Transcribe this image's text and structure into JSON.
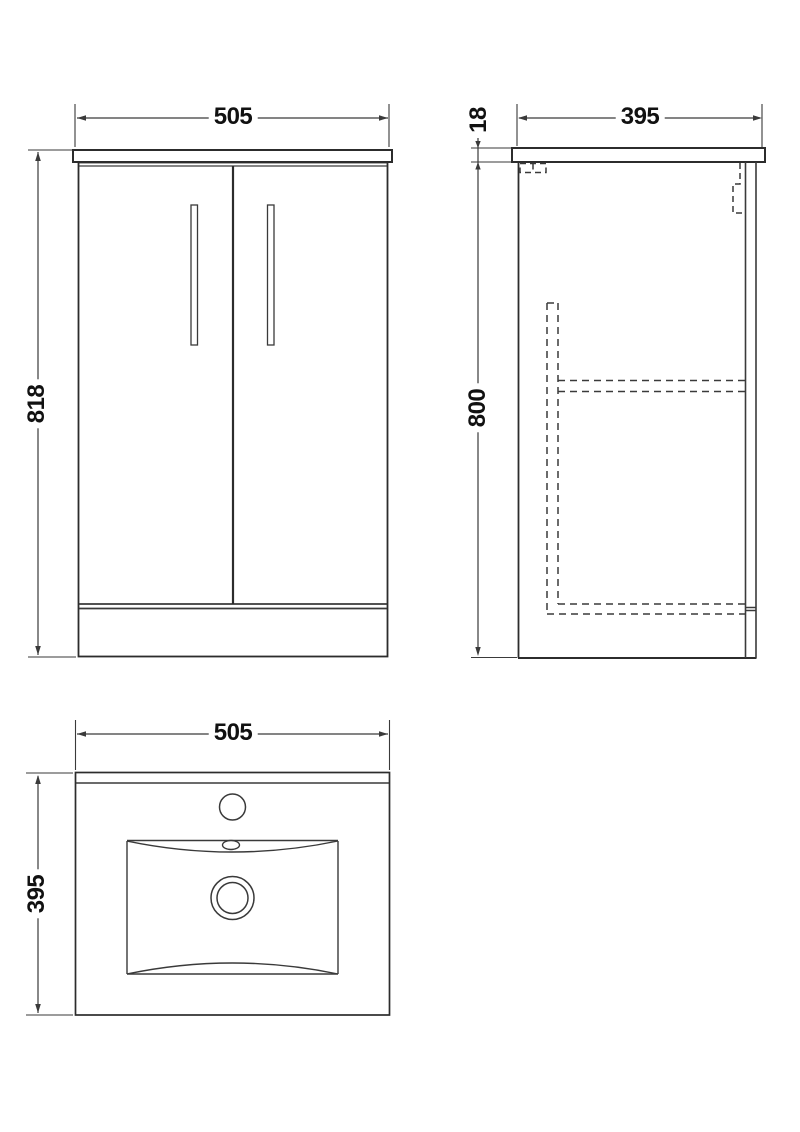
{
  "drawing": {
    "description": "Vanity unit technical drawing with three orthographic views",
    "background_color": "#ffffff",
    "line_color": "#3a3a3a",
    "text_color": "#111111",
    "front_view": {
      "width_dim": "505",
      "height_dim": "818"
    },
    "side_view": {
      "depth_dim": "395",
      "worktop_thickness_dim": "18",
      "cabinet_height_dim": "800"
    },
    "basin_plan_view": {
      "width_dim": "505",
      "depth_dim": "395"
    }
  }
}
